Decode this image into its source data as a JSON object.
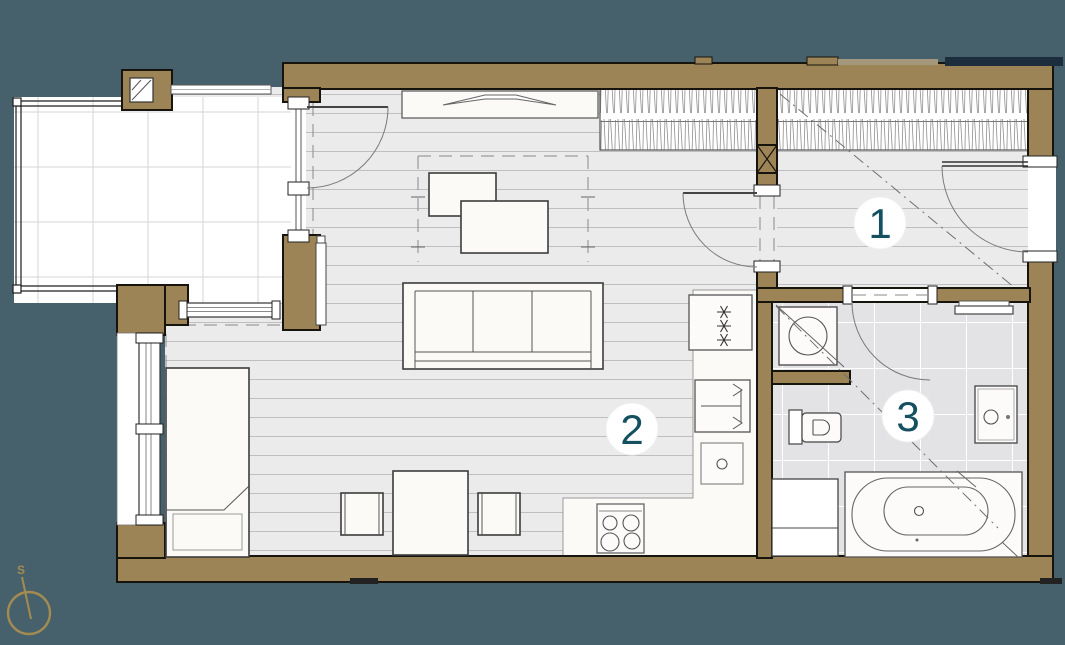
{
  "plan": {
    "room_labels": [
      "1",
      "2",
      "3"
    ],
    "compass_label": "S",
    "colors": {
      "background": "#46616b",
      "wall": "#9c8456",
      "outline": "#17130d",
      "floor": "#ebebec",
      "plank_line": "#bfbfc2",
      "tile_floor": "#e3e3e5",
      "tile_grout": "#ffffff",
      "balcony_grid": "#d5d5d5",
      "furniture_fill": "#fbfaf7",
      "furniture_line": "#3c3c3c",
      "room_number": "#14505f",
      "compass_gold": "#a38b52",
      "lintel_navy": "#1c2e3e"
    }
  }
}
